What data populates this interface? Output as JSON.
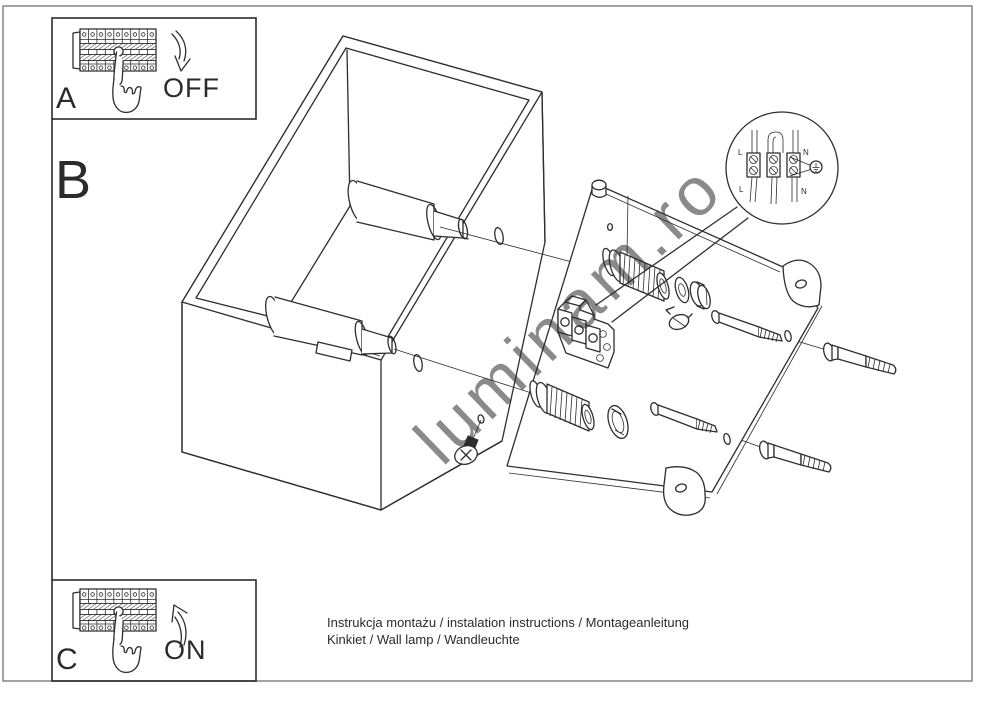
{
  "sections": {
    "a": {
      "label": "A",
      "action": "OFF"
    },
    "b": {
      "label": "B"
    },
    "c": {
      "label": "C",
      "action": "ON"
    }
  },
  "callout": {
    "top_left": "L",
    "top_right": "N",
    "bottom_left": "L",
    "bottom_right": "N"
  },
  "watermark": "luminam.ro",
  "footer": {
    "line1": "Instrukcja montażu / instalation instructions / Montageanleitung",
    "line2": "Kinkiet / Wall lamp / Wandleuchte"
  },
  "colors": {
    "line": "#2e2e2e",
    "page_border": "#8c8c8c",
    "watermark": "#c3c3c3"
  }
}
